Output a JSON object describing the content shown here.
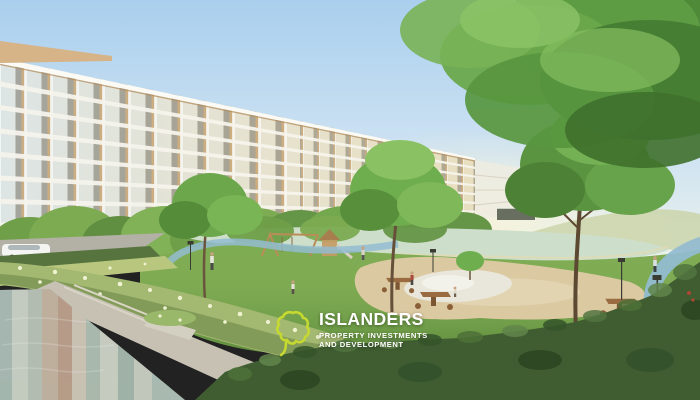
{
  "scene": {
    "description": "Architectural rendering of a low-rise condominium with swimming pool, lagoon, jogging path and landscaped park"
  },
  "logo": {
    "brand": "ISLANDERS",
    "tagline_line1": "PROPERTY INVESTMENTS",
    "tagline_line2": "AND DEVELOPMENT",
    "icon_name": "island-outline-icon",
    "icon_color": "#c6d930",
    "text_color": "#ffffff"
  },
  "palette": {
    "sky_top": "#a9cfee",
    "sky_horizon": "#ecf2ec",
    "building_glass_cool": "#dde5e4",
    "building_glass_warm": "#e8dfc0",
    "building_slab": "#f6f4ec",
    "building_wood": "#c49a62",
    "roof_parapet": "#d6b488",
    "lagoon_water": "#cddfca",
    "lawn_green": "#7dab52",
    "tree_green": "#6aa84c",
    "hedge_dark": "#3f5d31",
    "hedge_flower": "#a3b871",
    "plaza_sand": "#dbc9a2",
    "platform_white": "#e9e7db",
    "jogging_path_blue": "#93bcd1",
    "pool_water": "#a9bab3",
    "pool_deck": "#c6c1b2",
    "road_gray": "#b3b0a6",
    "car_white": "#f4f4f2",
    "table_wood": "#9a6b40"
  }
}
